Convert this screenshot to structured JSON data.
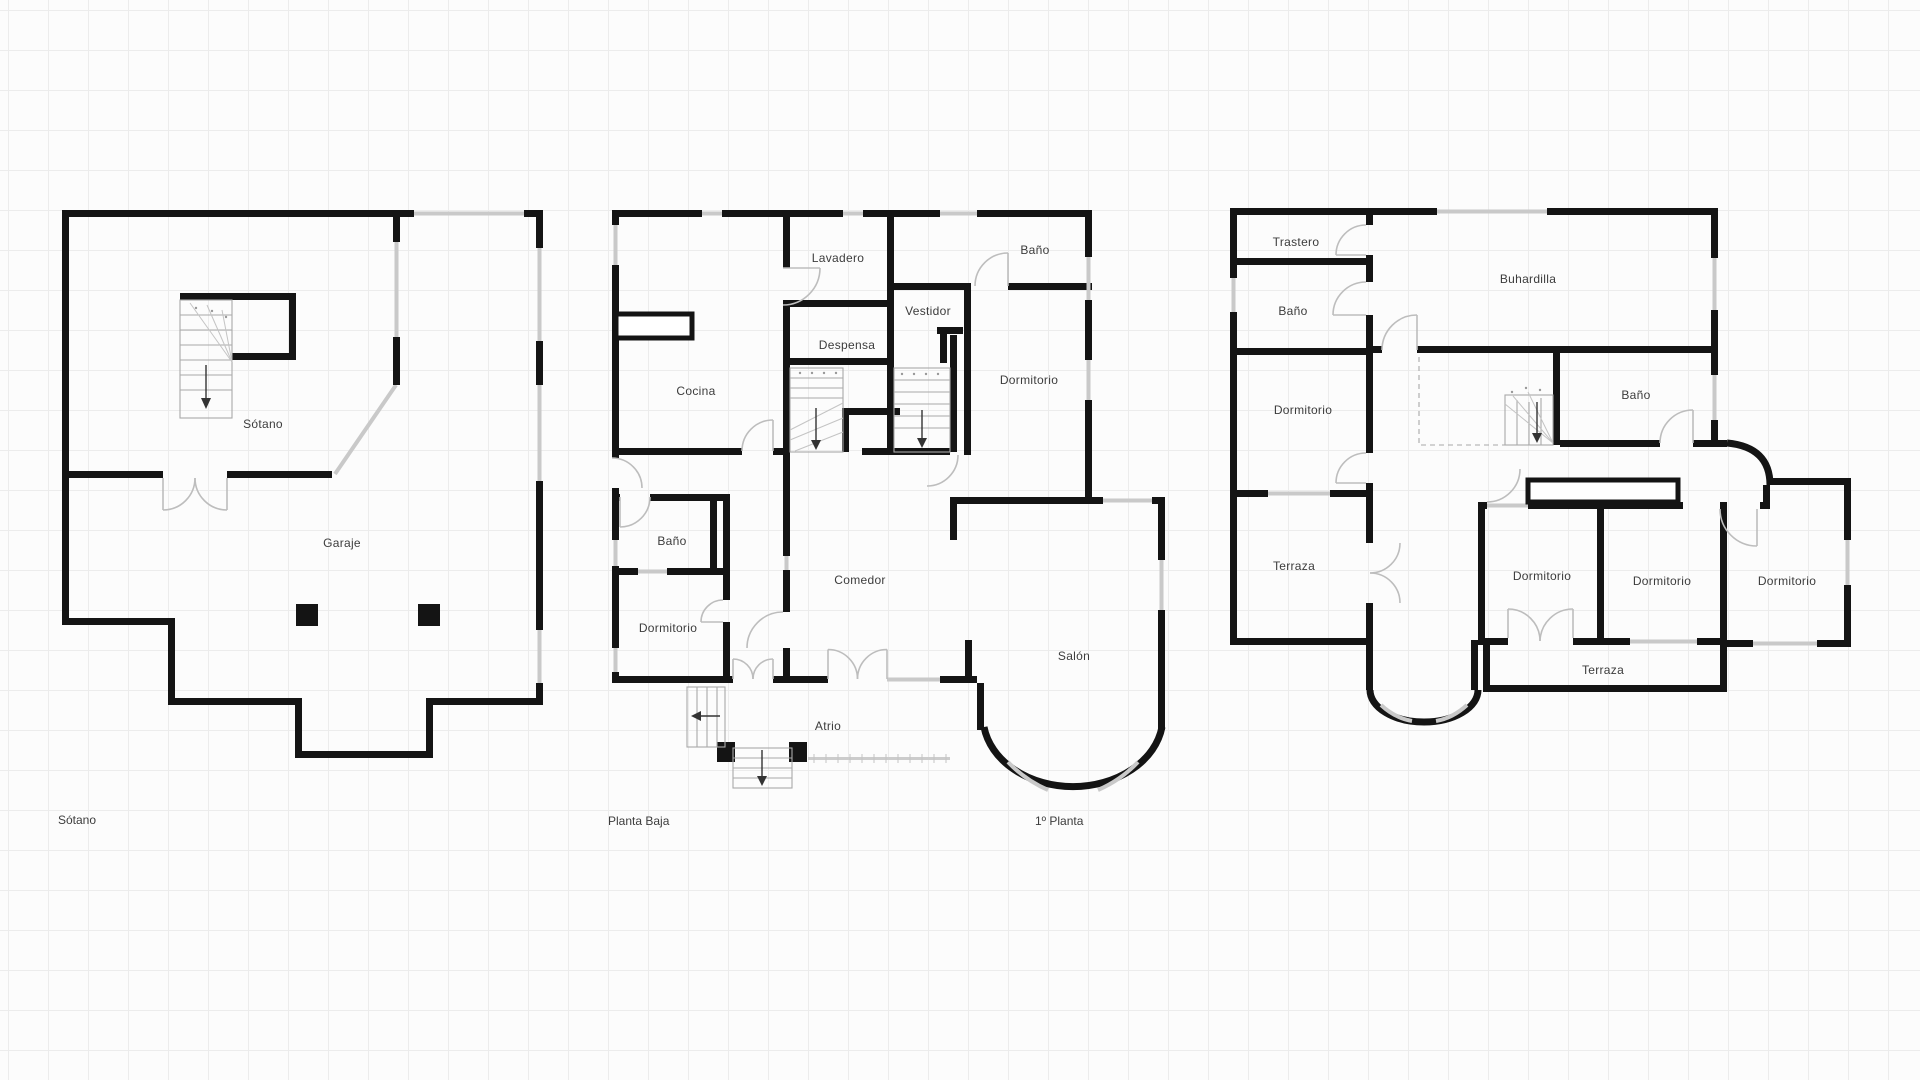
{
  "document": {
    "type": "architectural-floor-plans",
    "sheet_style": "light-grid-paper"
  },
  "colors": {
    "wall": "#141414",
    "window": "#c9c9c9",
    "door_arc": "#bdbdbd",
    "label_text": "#3c3c3c",
    "grid_line": "#ececec",
    "background": "#fcfcfc"
  },
  "plans": [
    {
      "caption": "Sótano",
      "rooms": [
        {
          "label": "Sótano"
        },
        {
          "label": "Garaje"
        }
      ]
    },
    {
      "caption": "Planta Baja",
      "rooms": [
        {
          "label": "Lavadero"
        },
        {
          "label": "Baño"
        },
        {
          "label": "Vestidor"
        },
        {
          "label": "Despensa"
        },
        {
          "label": "Cocina"
        },
        {
          "label": "Dormitorio"
        },
        {
          "label": "Baño"
        },
        {
          "label": "Dormitorio"
        },
        {
          "label": "Comedor"
        },
        {
          "label": "Salón"
        },
        {
          "label": "Atrio"
        }
      ]
    },
    {
      "caption": "1º Planta",
      "rooms": [
        {
          "label": "Trastero"
        },
        {
          "label": "Buhardilla"
        },
        {
          "label": "Baño"
        },
        {
          "label": "Dormitorio"
        },
        {
          "label": "Baño"
        },
        {
          "label": "Terraza"
        },
        {
          "label": "Dormitorio"
        },
        {
          "label": "Dormitorio"
        },
        {
          "label": "Dormitorio"
        },
        {
          "label": "Terraza"
        }
      ]
    }
  ]
}
